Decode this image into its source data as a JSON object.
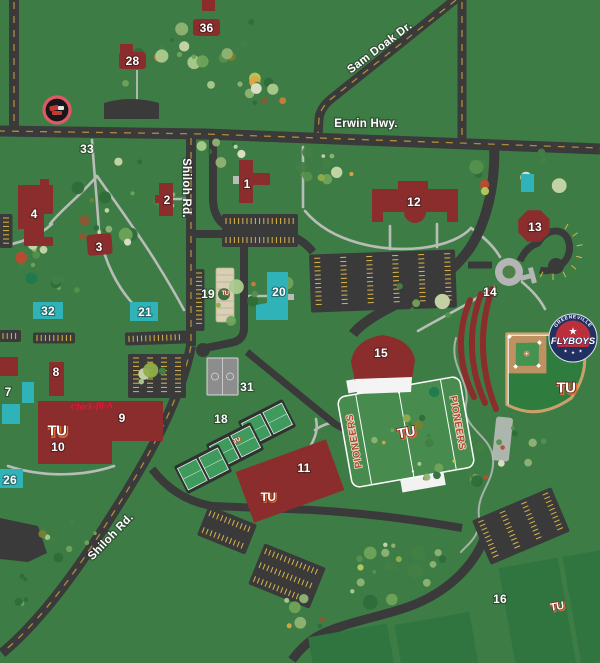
{
  "map": {
    "roads": {
      "sam_doak": "Sam Doak Dr.",
      "erwin": "Erwin Hwy.",
      "shiloh_upper": "Shiloh Rd.",
      "shiloh_lower": "Shiloh Rd."
    },
    "labels": {
      "b1": "1",
      "b2": "2",
      "b3": "3",
      "b4": "4",
      "b7": "7",
      "b8": "8",
      "b9": "9",
      "b10": "10",
      "b11": "11",
      "b12": "12",
      "b13": "13",
      "b14": "14",
      "b15": "15",
      "b16": "16",
      "b18": "18",
      "b19": "19",
      "b20": "20",
      "b21": "21",
      "b26": "26",
      "b28": "28",
      "b31": "31",
      "b32": "32",
      "b33": "33",
      "b36": "36"
    },
    "football": {
      "endzone_text": "PIONEERS"
    },
    "tu_monogram": "TU",
    "flyboys": {
      "city": "GREENEVILLE",
      "team": "FLYBOYS"
    },
    "chick_fil_a": "Chick-fil-A",
    "colors": {
      "background": "#3e7c46",
      "road": "#3a3a3a",
      "path": "#b9bdb7",
      "building": "#8c2d2d",
      "athletic_teal": "#2fb3b8",
      "parking_stripe": "#d9b64a",
      "centerline": "#c9a23f",
      "field_green": "#478b4e",
      "outfield_green": "#2e7d3f",
      "dirt_tan": "#bd9162",
      "court_green": "#3f9a5d",
      "court_gray": "#8d8d8d",
      "beige": "#d8cfb4",
      "flyboys_navy": "#203060",
      "flyboys_red": "#bb2f3d",
      "tu_orange": "#d96b2f",
      "chick_fil_a_red": "#e5173a"
    }
  }
}
